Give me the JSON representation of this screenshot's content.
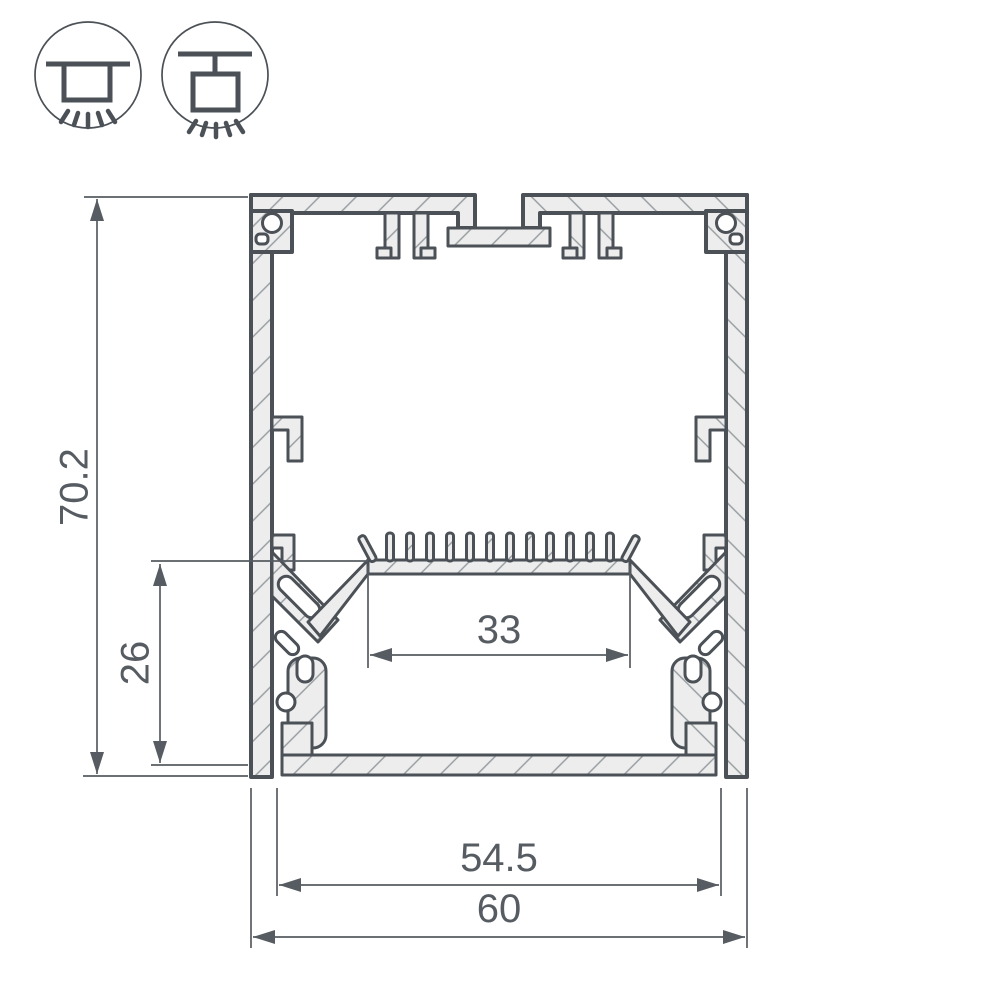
{
  "drawing": {
    "type": "profile-cross-section-technical-drawing"
  },
  "icons": [
    {
      "name": "surface-mount-light-icon"
    },
    {
      "name": "pendant-light-icon"
    }
  ],
  "dimensions": {
    "overall_height": "70.2",
    "inner_height": "26",
    "led_platform_width": "33",
    "inner_width": "54.5",
    "overall_width": "60"
  },
  "colors": {
    "background": "#ffffff",
    "outline": "#4b5156",
    "material_fill": "#ededed",
    "hatch_line": "#949a9e",
    "dimension": "#565c61"
  }
}
